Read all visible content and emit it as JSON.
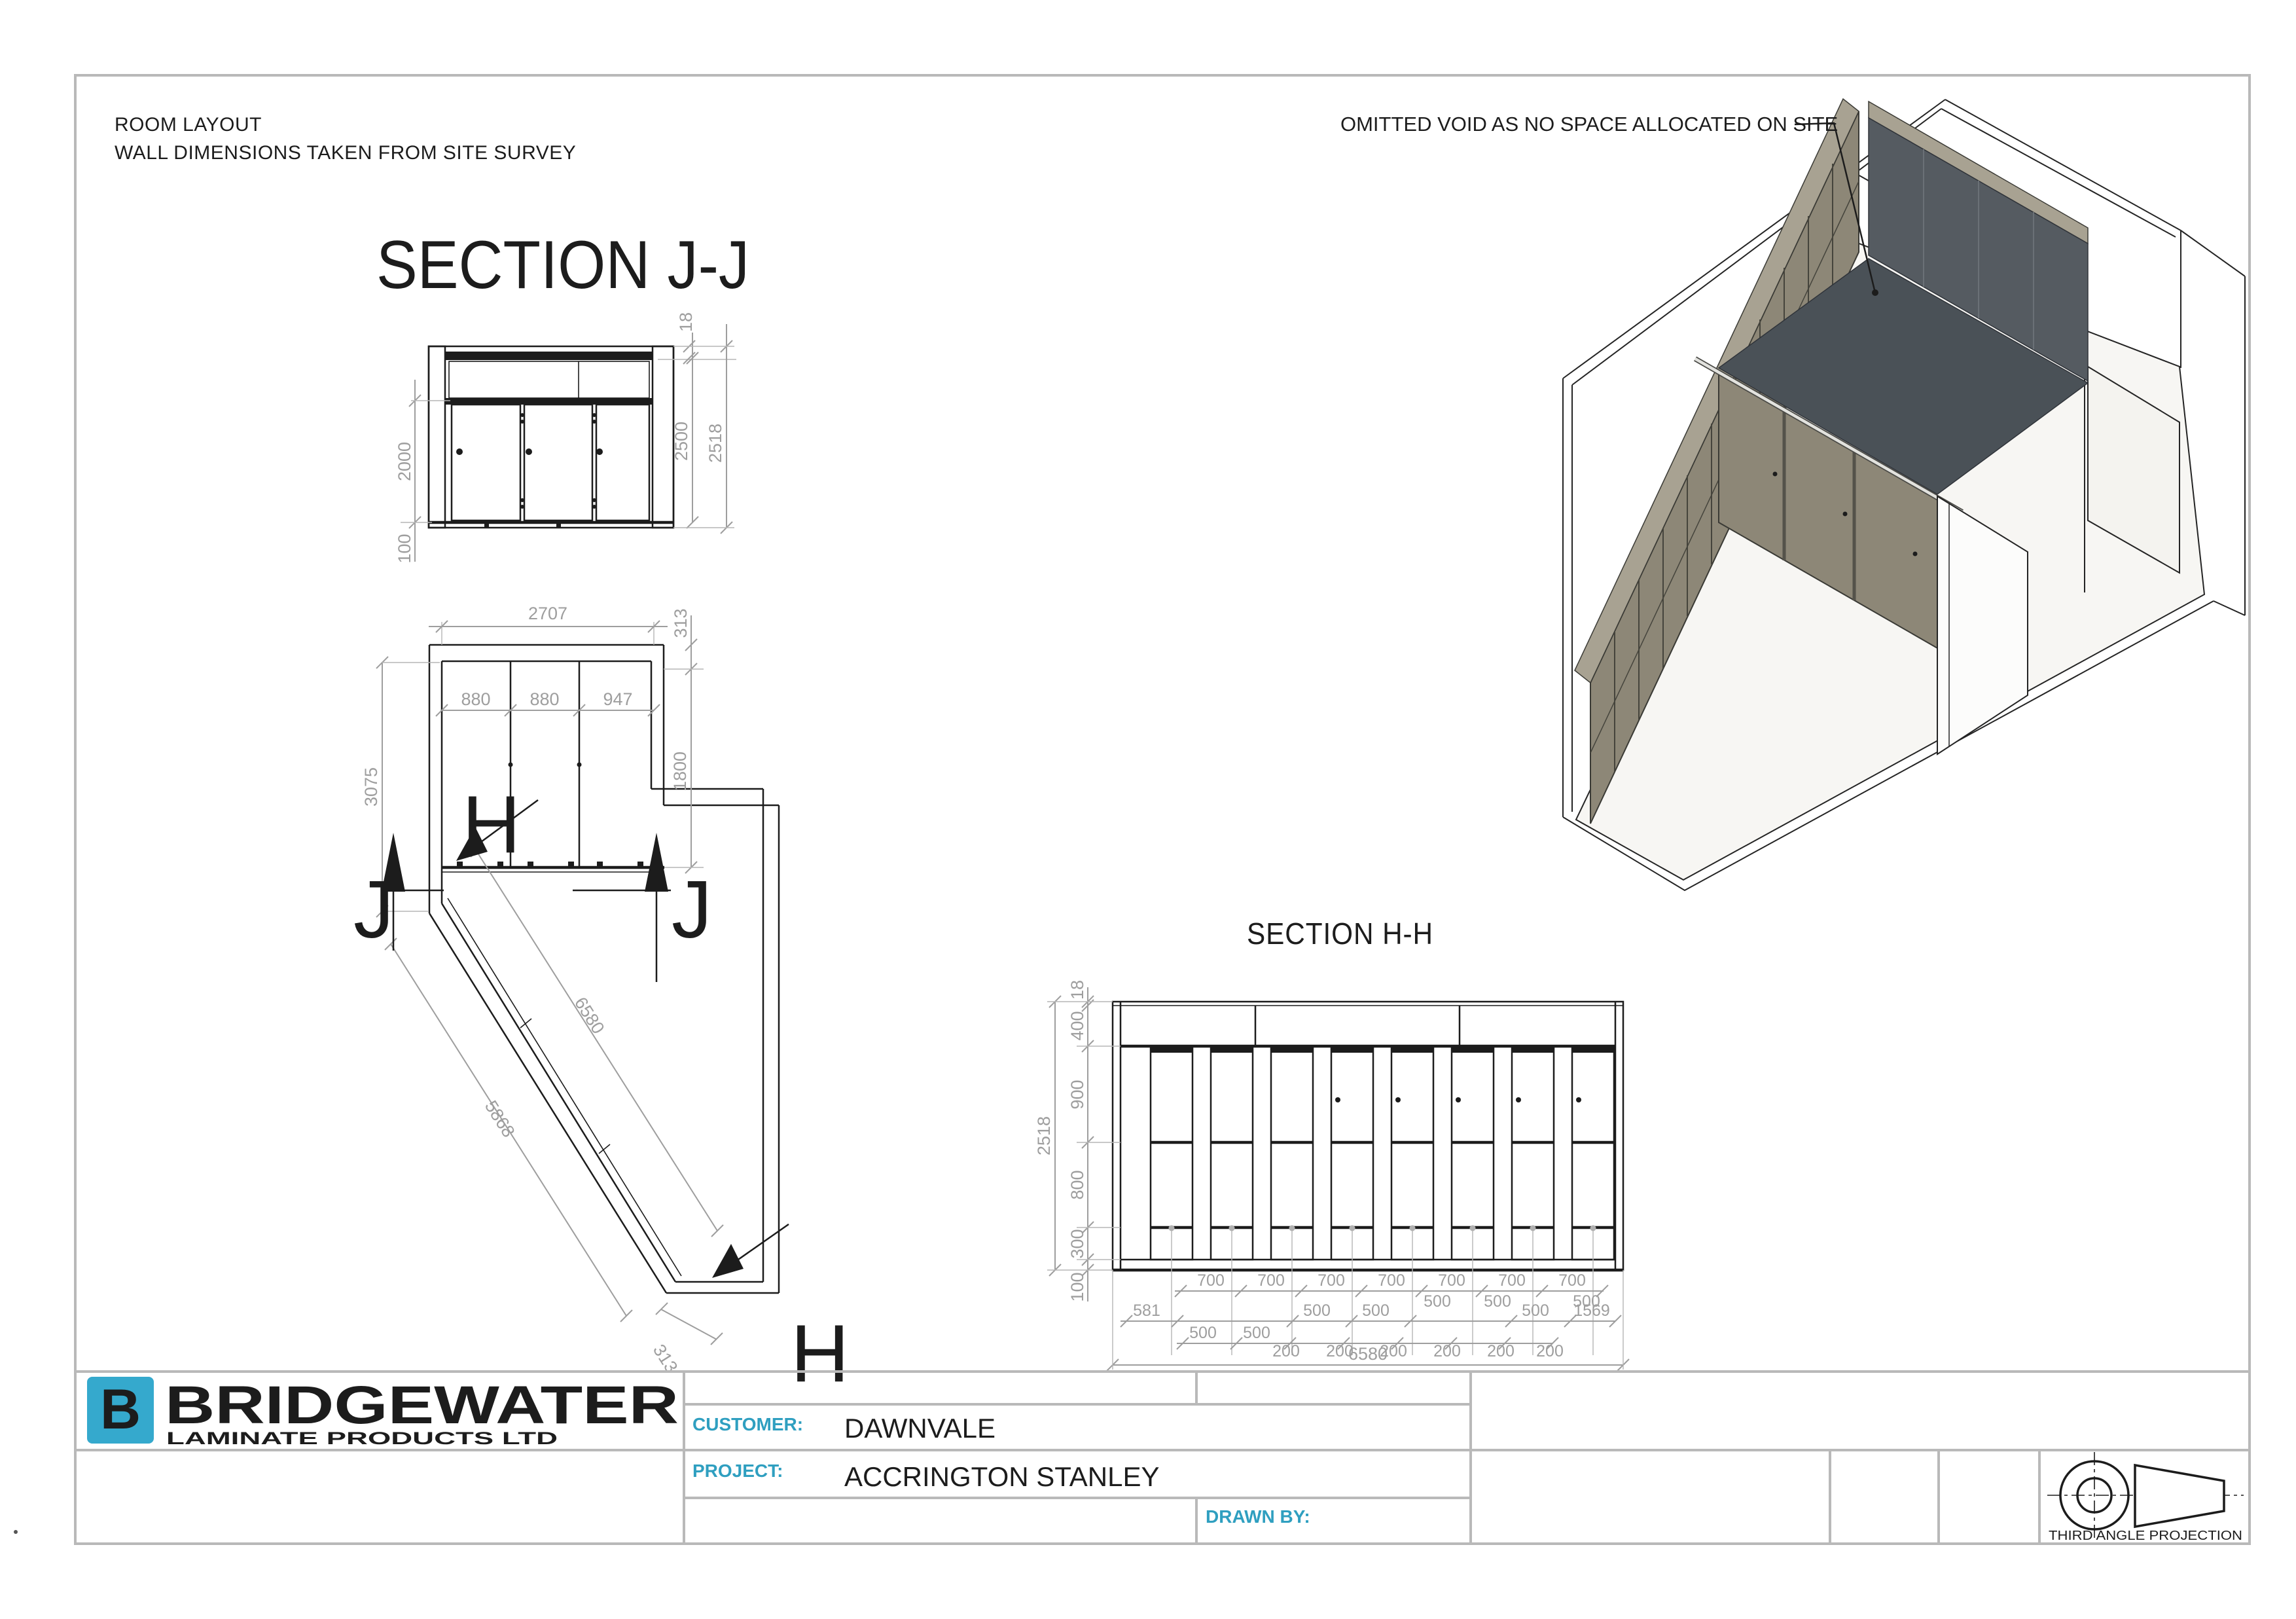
{
  "notes": {
    "line1": "ROOM LAYOUT",
    "line2": "WALL DIMENSIONS TAKEN FROM SITE SURVEY"
  },
  "section_jj": {
    "title": "SECTION J-J",
    "dim_2000": "2000",
    "dim_100": "100",
    "dim_18": "18",
    "dim_2500": "2500",
    "dim_2518": "2518"
  },
  "plan": {
    "dim_2707": "2707",
    "dim_313_top": "313",
    "dim_880_a": "880",
    "dim_880_b": "880",
    "dim_947": "947",
    "dim_1800": "1800",
    "dim_3075": "3075",
    "dim_6580": "6580",
    "dim_5868": "5868",
    "dim_313_bottom": "313",
    "marker_j": "J",
    "marker_h": "H"
  },
  "iso": {
    "annotation": "OMITTED VOID AS NO SPACE ALLOCATED ON SITE",
    "panel_color": "#8d8777",
    "panel_top_color": "#a8a292",
    "partition_color": "#555b61",
    "interior_color": "#4a5157"
  },
  "section_hh": {
    "title": "SECTION H-H",
    "left_dims": {
      "d18": "18",
      "d400": "400",
      "d900": "900",
      "d800": "800",
      "d300": "300",
      "d100": "100",
      "d2518": "2518"
    },
    "row_700": [
      "700",
      "700",
      "700",
      "700",
      "700",
      "700",
      "700"
    ],
    "row_500_inline": [
      "500",
      "500",
      "500"
    ],
    "row_b": [
      "581",
      "500",
      "500",
      "500",
      "1569"
    ],
    "row_c": [
      "500",
      "500",
      "200",
      "200",
      "200",
      "200",
      "200",
      "200"
    ],
    "dim_total": "6580"
  },
  "title_block": {
    "brand": {
      "letter": "B",
      "name": "BRIDGEWATER",
      "subtitle": "LAMINATE PRODUCTS LTD",
      "blue": "#2d6da8",
      "teal": "#35a9cd"
    },
    "customer_label": "CUSTOMER:",
    "customer_value": "DAWNVALE",
    "project_label": "PROJECT:",
    "project_value": "ACCRINGTON STANLEY",
    "drawn_by_label": "DRAWN BY:",
    "projection_label": "THIRD ANGLE PROJECTION"
  }
}
